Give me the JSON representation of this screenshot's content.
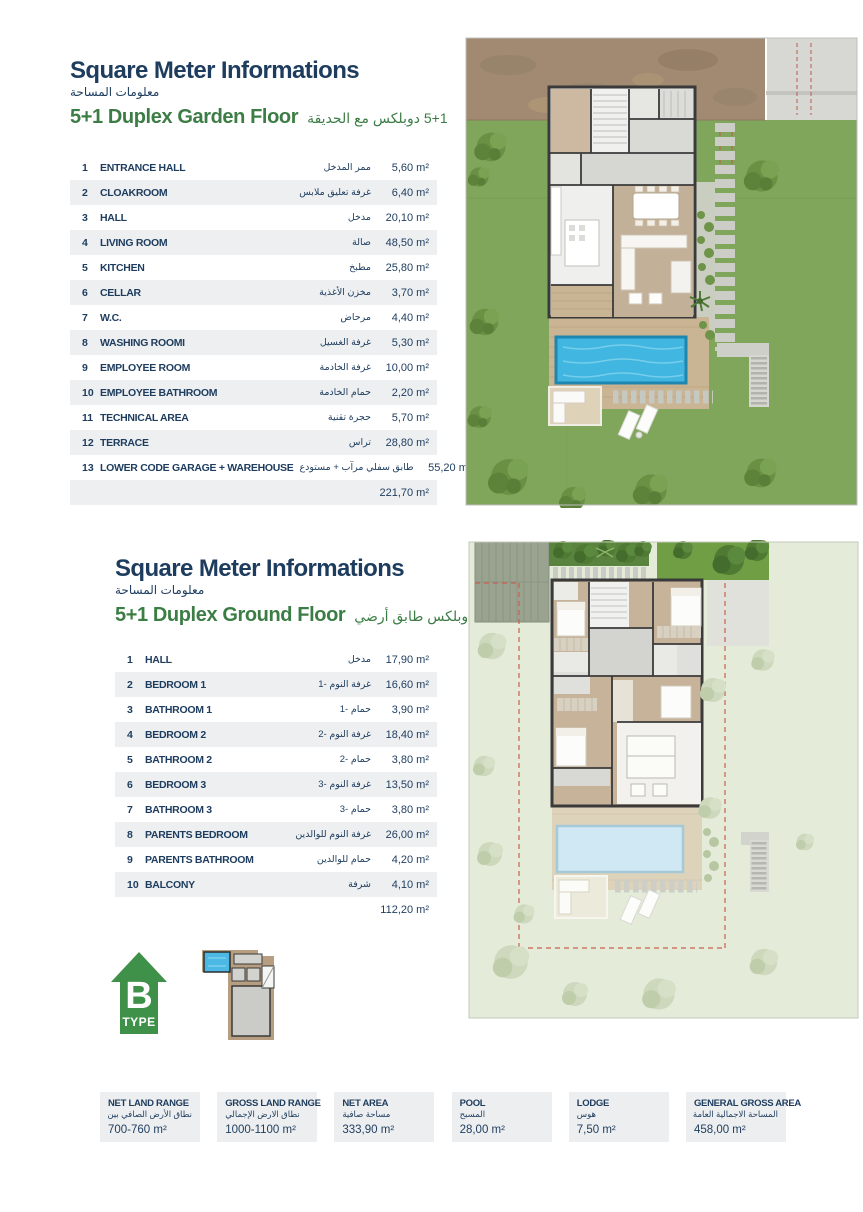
{
  "colors": {
    "navy": "#1d3c5e",
    "green": "#3c7d45",
    "row_alt": "#edeff1",
    "footer_bg": "#edeeef",
    "badge_green": "#3f9149",
    "lawn_green": "#80a65c",
    "pool_blue": "#40b6e1",
    "pale_garden": "#e4ebd9",
    "dirt_brown": "#a18a71"
  },
  "sections": [
    {
      "title": "Square Meter Informations",
      "title_ar": "معلومات المساحة",
      "subtitle": "5+1 Duplex Garden Floor",
      "subtitle_ar": "5+1 دوبلكس مع الحديقة",
      "rows": [
        [
          "1",
          "ENTRANCE HALL",
          "ممر المدخل",
          "5,60 m²"
        ],
        [
          "2",
          "CLOAKROOM",
          "غرفة تعليق ملابس",
          "6,40 m²"
        ],
        [
          "3",
          "HALL",
          "مدخل",
          "20,10 m²"
        ],
        [
          "4",
          "LIVING ROOM",
          "صالة",
          "48,50 m²"
        ],
        [
          "5",
          "KITCHEN",
          "مطبخ",
          "25,80 m²"
        ],
        [
          "6",
          "CELLAR",
          "مخزن الأغذية",
          "3,70 m²"
        ],
        [
          "7",
          "W.C.",
          "مرحاض",
          "4,40 m²"
        ],
        [
          "8",
          "WASHING ROOMI",
          "غرفة الغسيل",
          "5,30 m²"
        ],
        [
          "9",
          "EMPLOYEE ROOM",
          "غرفة الخادمة",
          "10,00 m²"
        ],
        [
          "10",
          "EMPLOYEE BATHROOM",
          "حمام الخادمة",
          "2,20 m²"
        ],
        [
          "11",
          "TECHNICAL AREA",
          "حجرة تقنية",
          "5,70 m²"
        ],
        [
          "12",
          "TERRACE",
          "تراس",
          "28,80 m²"
        ],
        [
          "13",
          "LOWER CODE GARAGE + WAREHOUSE",
          "طابق سفلي مرآب + مستودع",
          "55,20 m²"
        ]
      ],
      "total": "221,70 m²"
    },
    {
      "title": "Square Meter Informations",
      "title_ar": "معلومات المساحة",
      "subtitle": "5+1 Duplex Ground Floor",
      "subtitle_ar": "5+1 دوبلكس طابق أرضي",
      "rows": [
        [
          "1",
          "HALL",
          "مدخل",
          "17,90 m²"
        ],
        [
          "2",
          "BEDROOM 1",
          "غرفة النوم -1",
          "16,60 m²"
        ],
        [
          "3",
          "BATHROOM 1",
          "حمام -1",
          "3,90 m²"
        ],
        [
          "4",
          "BEDROOM 2",
          "غرفة النوم -2",
          "18,40 m²"
        ],
        [
          "5",
          "BATHROOM 2",
          "حمام -2",
          "3,80 m²"
        ],
        [
          "6",
          "BEDROOM 3",
          "غرفة النوم -3",
          "13,50 m²"
        ],
        [
          "7",
          "BATHROOM 3",
          "حمام -3",
          "3,80 m²"
        ],
        [
          "8",
          "PARENTS BEDROOM",
          "غرفة النوم للوالدين",
          "26,00 m²"
        ],
        [
          "9",
          "PARENTS BATHROOM",
          "حمام للوالدين",
          "4,20 m²"
        ],
        [
          "10",
          "BALCONY",
          "شرفة",
          "4,10 m²"
        ]
      ],
      "total": "112,20 m²"
    }
  ],
  "type_badge": {
    "letter": "B",
    "label": "TYPE"
  },
  "footer": [
    {
      "label": "NET LAND RANGE",
      "label_ar": "نطاق الأرض الصافي بين",
      "value": "700-760 m²"
    },
    {
      "label": "GROSS LAND RANGE",
      "label_ar": "نطاق الارض الإجمالي",
      "value": "1000-1100 m²"
    },
    {
      "label": "NET AREA",
      "label_ar": "مساحة صافية",
      "value": "333,90 m²"
    },
    {
      "label": "POOL",
      "label_ar": "المسبح",
      "value": "28,00 m²"
    },
    {
      "label": "LODGE",
      "label_ar": "هوس",
      "value": "7,50 m²"
    },
    {
      "label": "GENERAL GROSS AREA",
      "label_ar": "المساحة الاجمالية العامة",
      "value": "458,00 m²"
    }
  ]
}
